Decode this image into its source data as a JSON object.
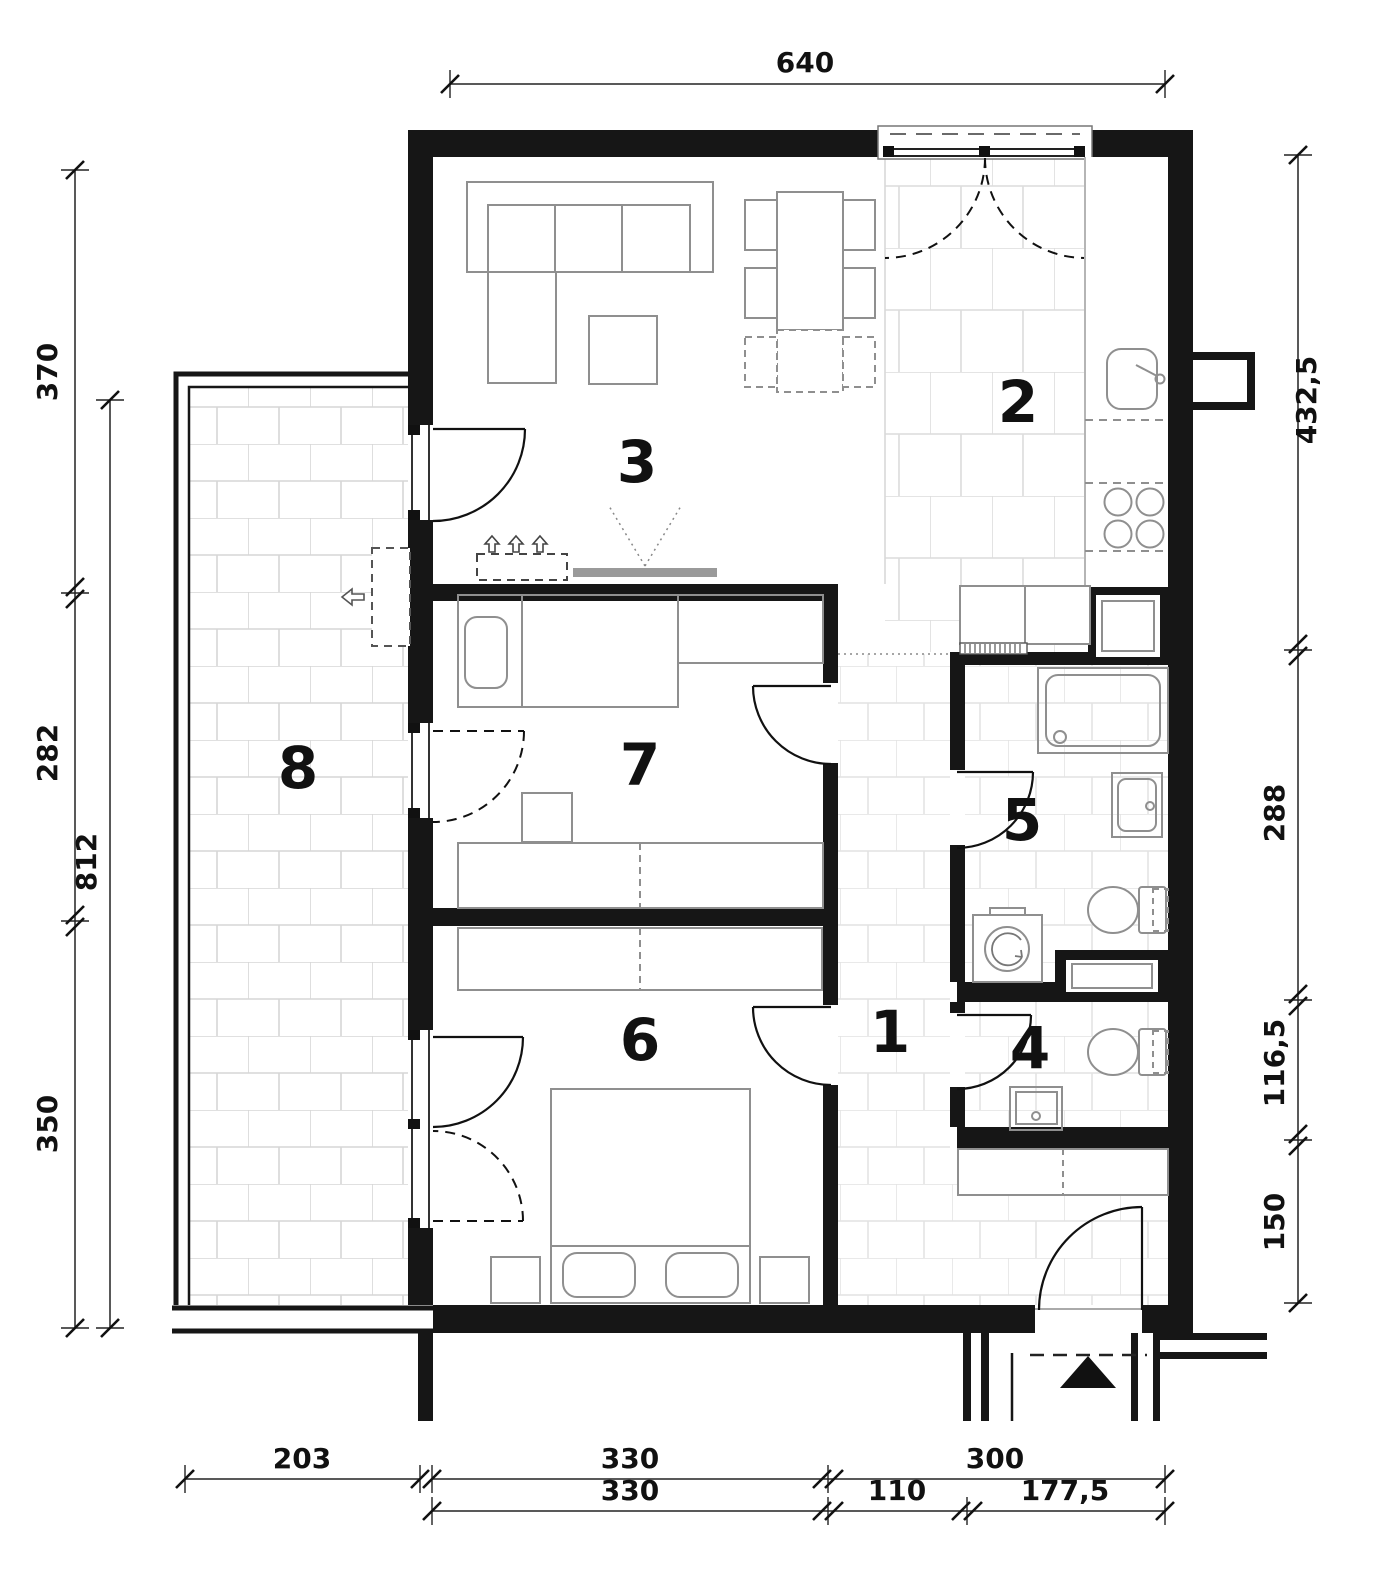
{
  "plan": {
    "rooms": [
      {
        "number": "1"
      },
      {
        "number": "2"
      },
      {
        "number": "3"
      },
      {
        "number": "4"
      },
      {
        "number": "5"
      },
      {
        "number": "6"
      },
      {
        "number": "7"
      },
      {
        "number": "8"
      }
    ],
    "dimensions": {
      "top": [
        "640"
      ],
      "left_outer": [
        "370",
        "282",
        "350"
      ],
      "left_overall": [
        "812"
      ],
      "right": [
        "432,5",
        "288",
        "116,5",
        "150"
      ],
      "bottom_upper": [
        "203",
        "330",
        "300"
      ],
      "bottom_lower": [
        "330",
        "110",
        "177,5"
      ]
    }
  }
}
